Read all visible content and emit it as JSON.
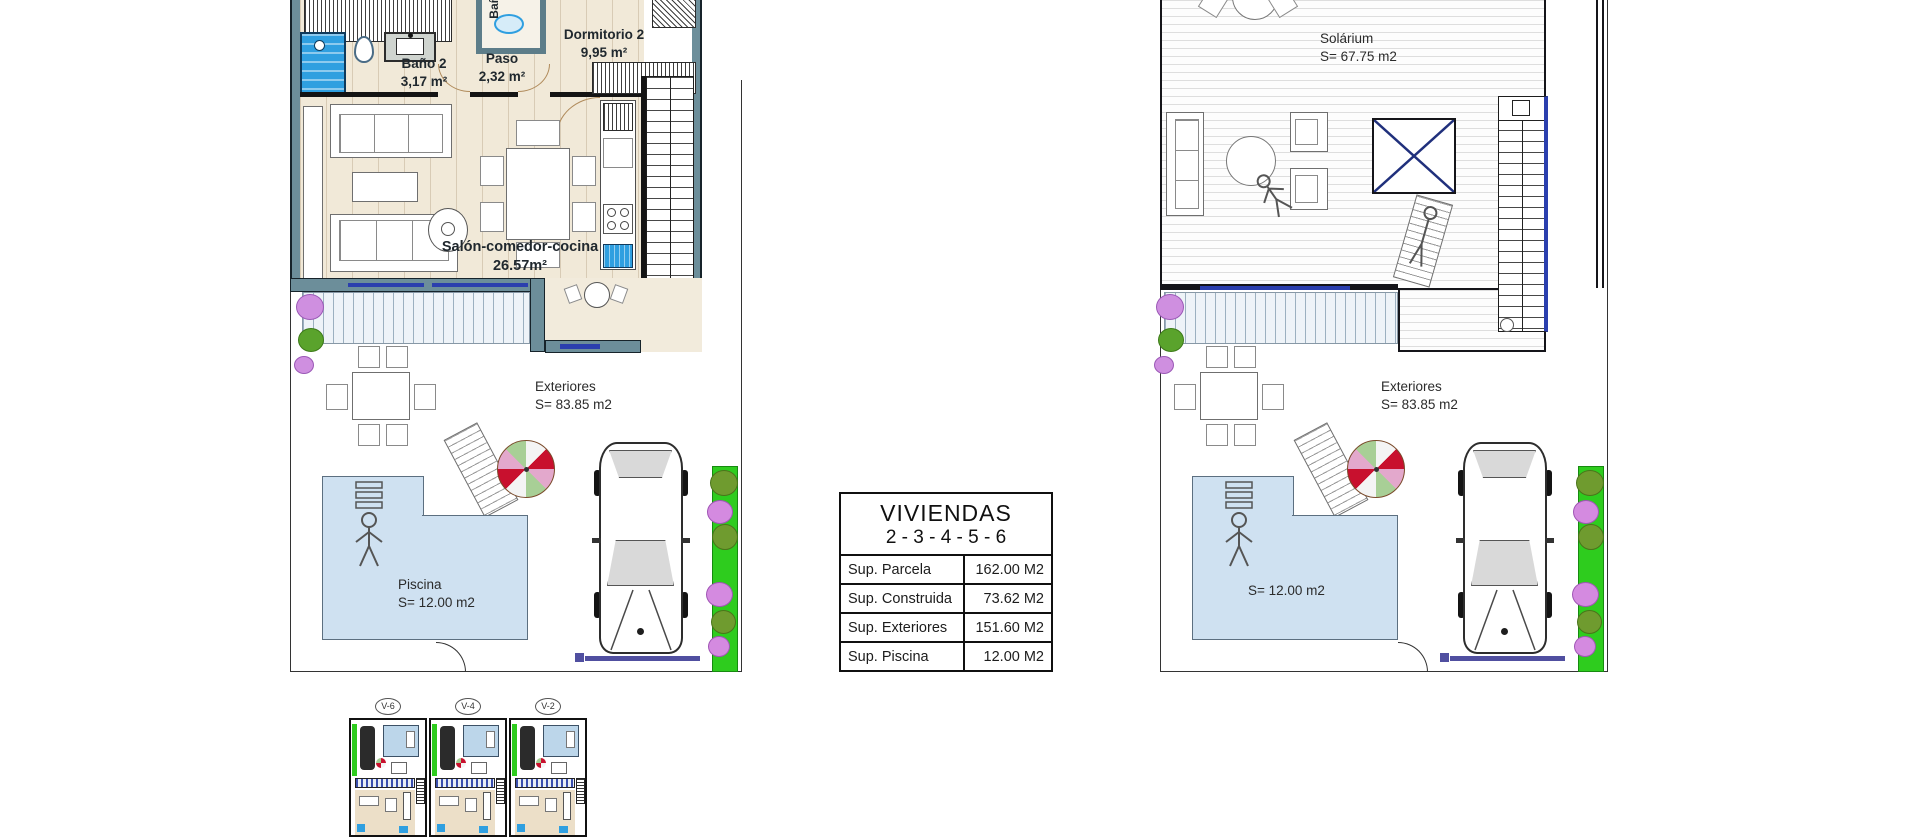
{
  "ground_floor": {
    "rooms": {
      "bano2": {
        "label": "Baño 2",
        "area": "3,17 m²"
      },
      "paso": {
        "label": "Paso",
        "area": "2,32 m²"
      },
      "dormitorio2": {
        "label": "Dormitorio 2",
        "area": "9,95 m²"
      },
      "salon": {
        "label": "Salón-comedor-cocina",
        "area": "26.57m²"
      },
      "bano_top": {
        "label": "Baño",
        "area": "3,"
      }
    },
    "exteriores": {
      "label": "Exteriores",
      "area": "S= 83.85 m2"
    },
    "piscina": {
      "label": "Piscina",
      "area": "S= 12.00 m2"
    }
  },
  "roof": {
    "solarium": {
      "label": "Solárium",
      "area": "S= 67.75 m2"
    },
    "exteriores": {
      "label": "Exteriores",
      "area": "S= 83.85 m2"
    },
    "piscina": {
      "area": "S= 12.00 m2"
    }
  },
  "summary_table": {
    "title": "VIVIENDAS",
    "subtitle": "2 - 3 - 4 - 5 - 6",
    "rows": [
      {
        "label": "Sup. Parcela",
        "value": "162.00 M2"
      },
      {
        "label": "Sup. Construida",
        "value": "73.62 M2"
      },
      {
        "label": "Sup. Exteriores",
        "value": "151.60 M2"
      },
      {
        "label": "Sup. Piscina",
        "value": "12.00 M2"
      }
    ]
  },
  "thumbnails": [
    {
      "label": "V-6"
    },
    {
      "label": "V-4"
    },
    {
      "label": "V-2"
    }
  ],
  "colors": {
    "wall": "#6c8e9a",
    "floor": "#f1e9d8",
    "pool": "#cfe1f1",
    "hedge": "#2ecc1e",
    "shower_blue": "#2f9fe0",
    "window_blue": "#2b3fae",
    "umbrella_red": "#c8102e"
  }
}
